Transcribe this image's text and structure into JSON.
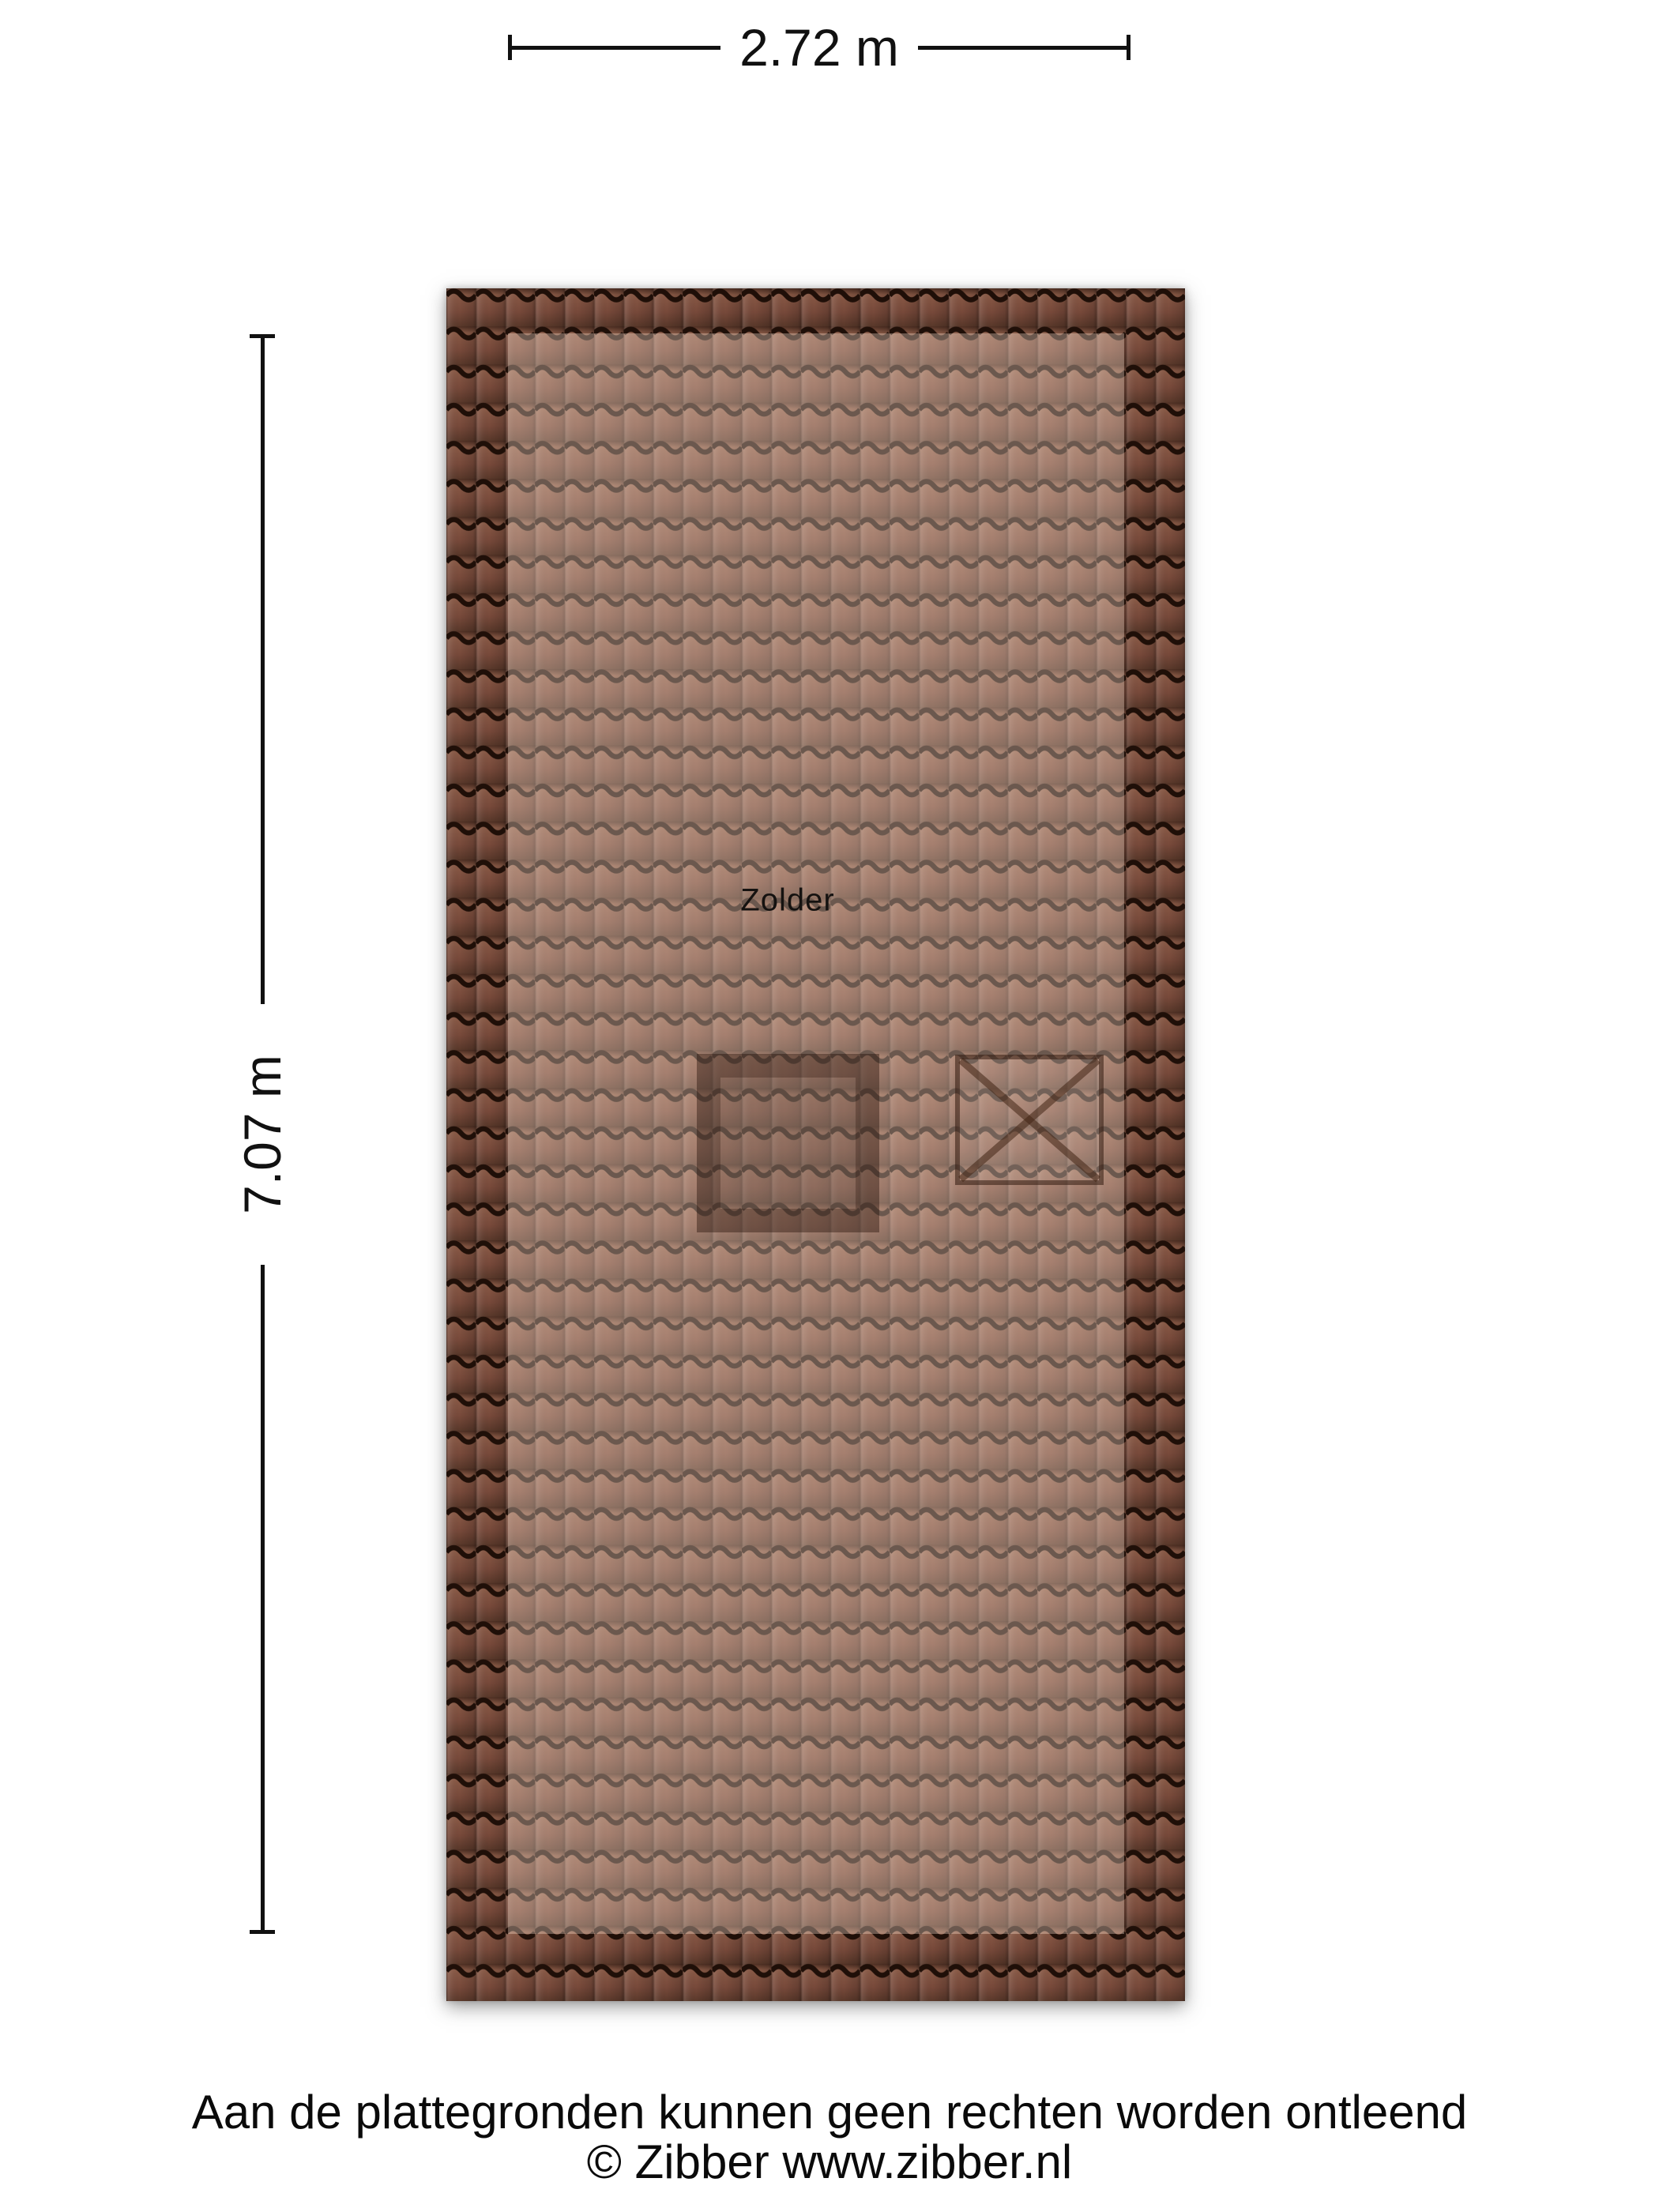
{
  "plan": {
    "room_label": "Zolder",
    "width_dimension": "2.72 m",
    "height_dimension": "7.07 m",
    "features": {
      "chimney": "chimney-shaft",
      "skylight": "skylight-cross"
    },
    "colors": {
      "tile_base": "#7a4b3a",
      "tile_groove": "#1f0f08",
      "room_highlight_overlay": "rgba(255,231,214,0.34)",
      "dimension_line": "#111111"
    }
  },
  "footer": {
    "disclaimer": "Aan de plattegronden kunnen geen rechten worden ontleend",
    "copyright": "© Zibber www.zibber.nl"
  }
}
